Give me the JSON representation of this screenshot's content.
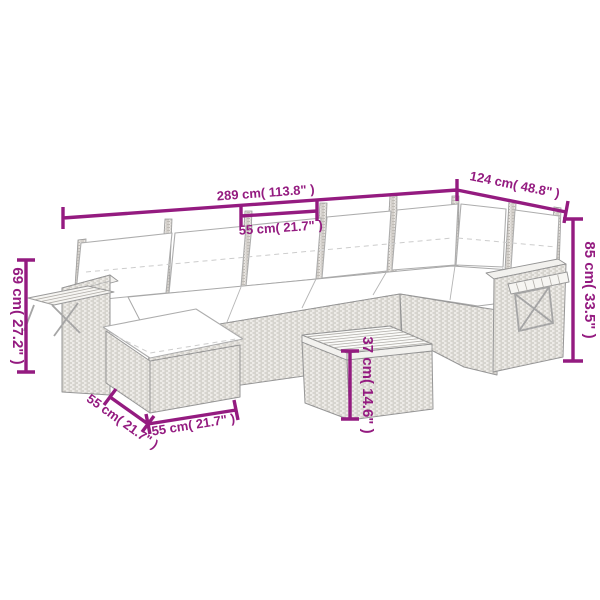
{
  "figure": {
    "subject": "poly rattan corner sofa set line drawing with seat cushions, ottoman, side shelves and coffee table",
    "background_color": "#ffffff",
    "dimension_color": "#941b80"
  },
  "dimensions": {
    "overall_width": {
      "label": "289 cm( 113.8\" )",
      "value_cm": 289
    },
    "overall_depth": {
      "label": "124 cm( 48.8\" )",
      "value_cm": 124
    },
    "seat_width": {
      "label": "55 cm( 21.7\" )",
      "value_cm": 55
    },
    "overall_height": {
      "label": "85 cm( 33.5\" )",
      "value_cm": 85
    },
    "shelf_height": {
      "label": "69 cm( 27.2\" )",
      "value_cm": 69
    },
    "ottoman_depth": {
      "label": "55 cm( 21.7\" )",
      "value_cm": 55
    },
    "ottoman_width": {
      "label": "55 cm( 21.7\" )",
      "value_cm": 55
    },
    "table_height": {
      "label": "37 cm( 14.6\" )",
      "value_cm": 37
    }
  }
}
